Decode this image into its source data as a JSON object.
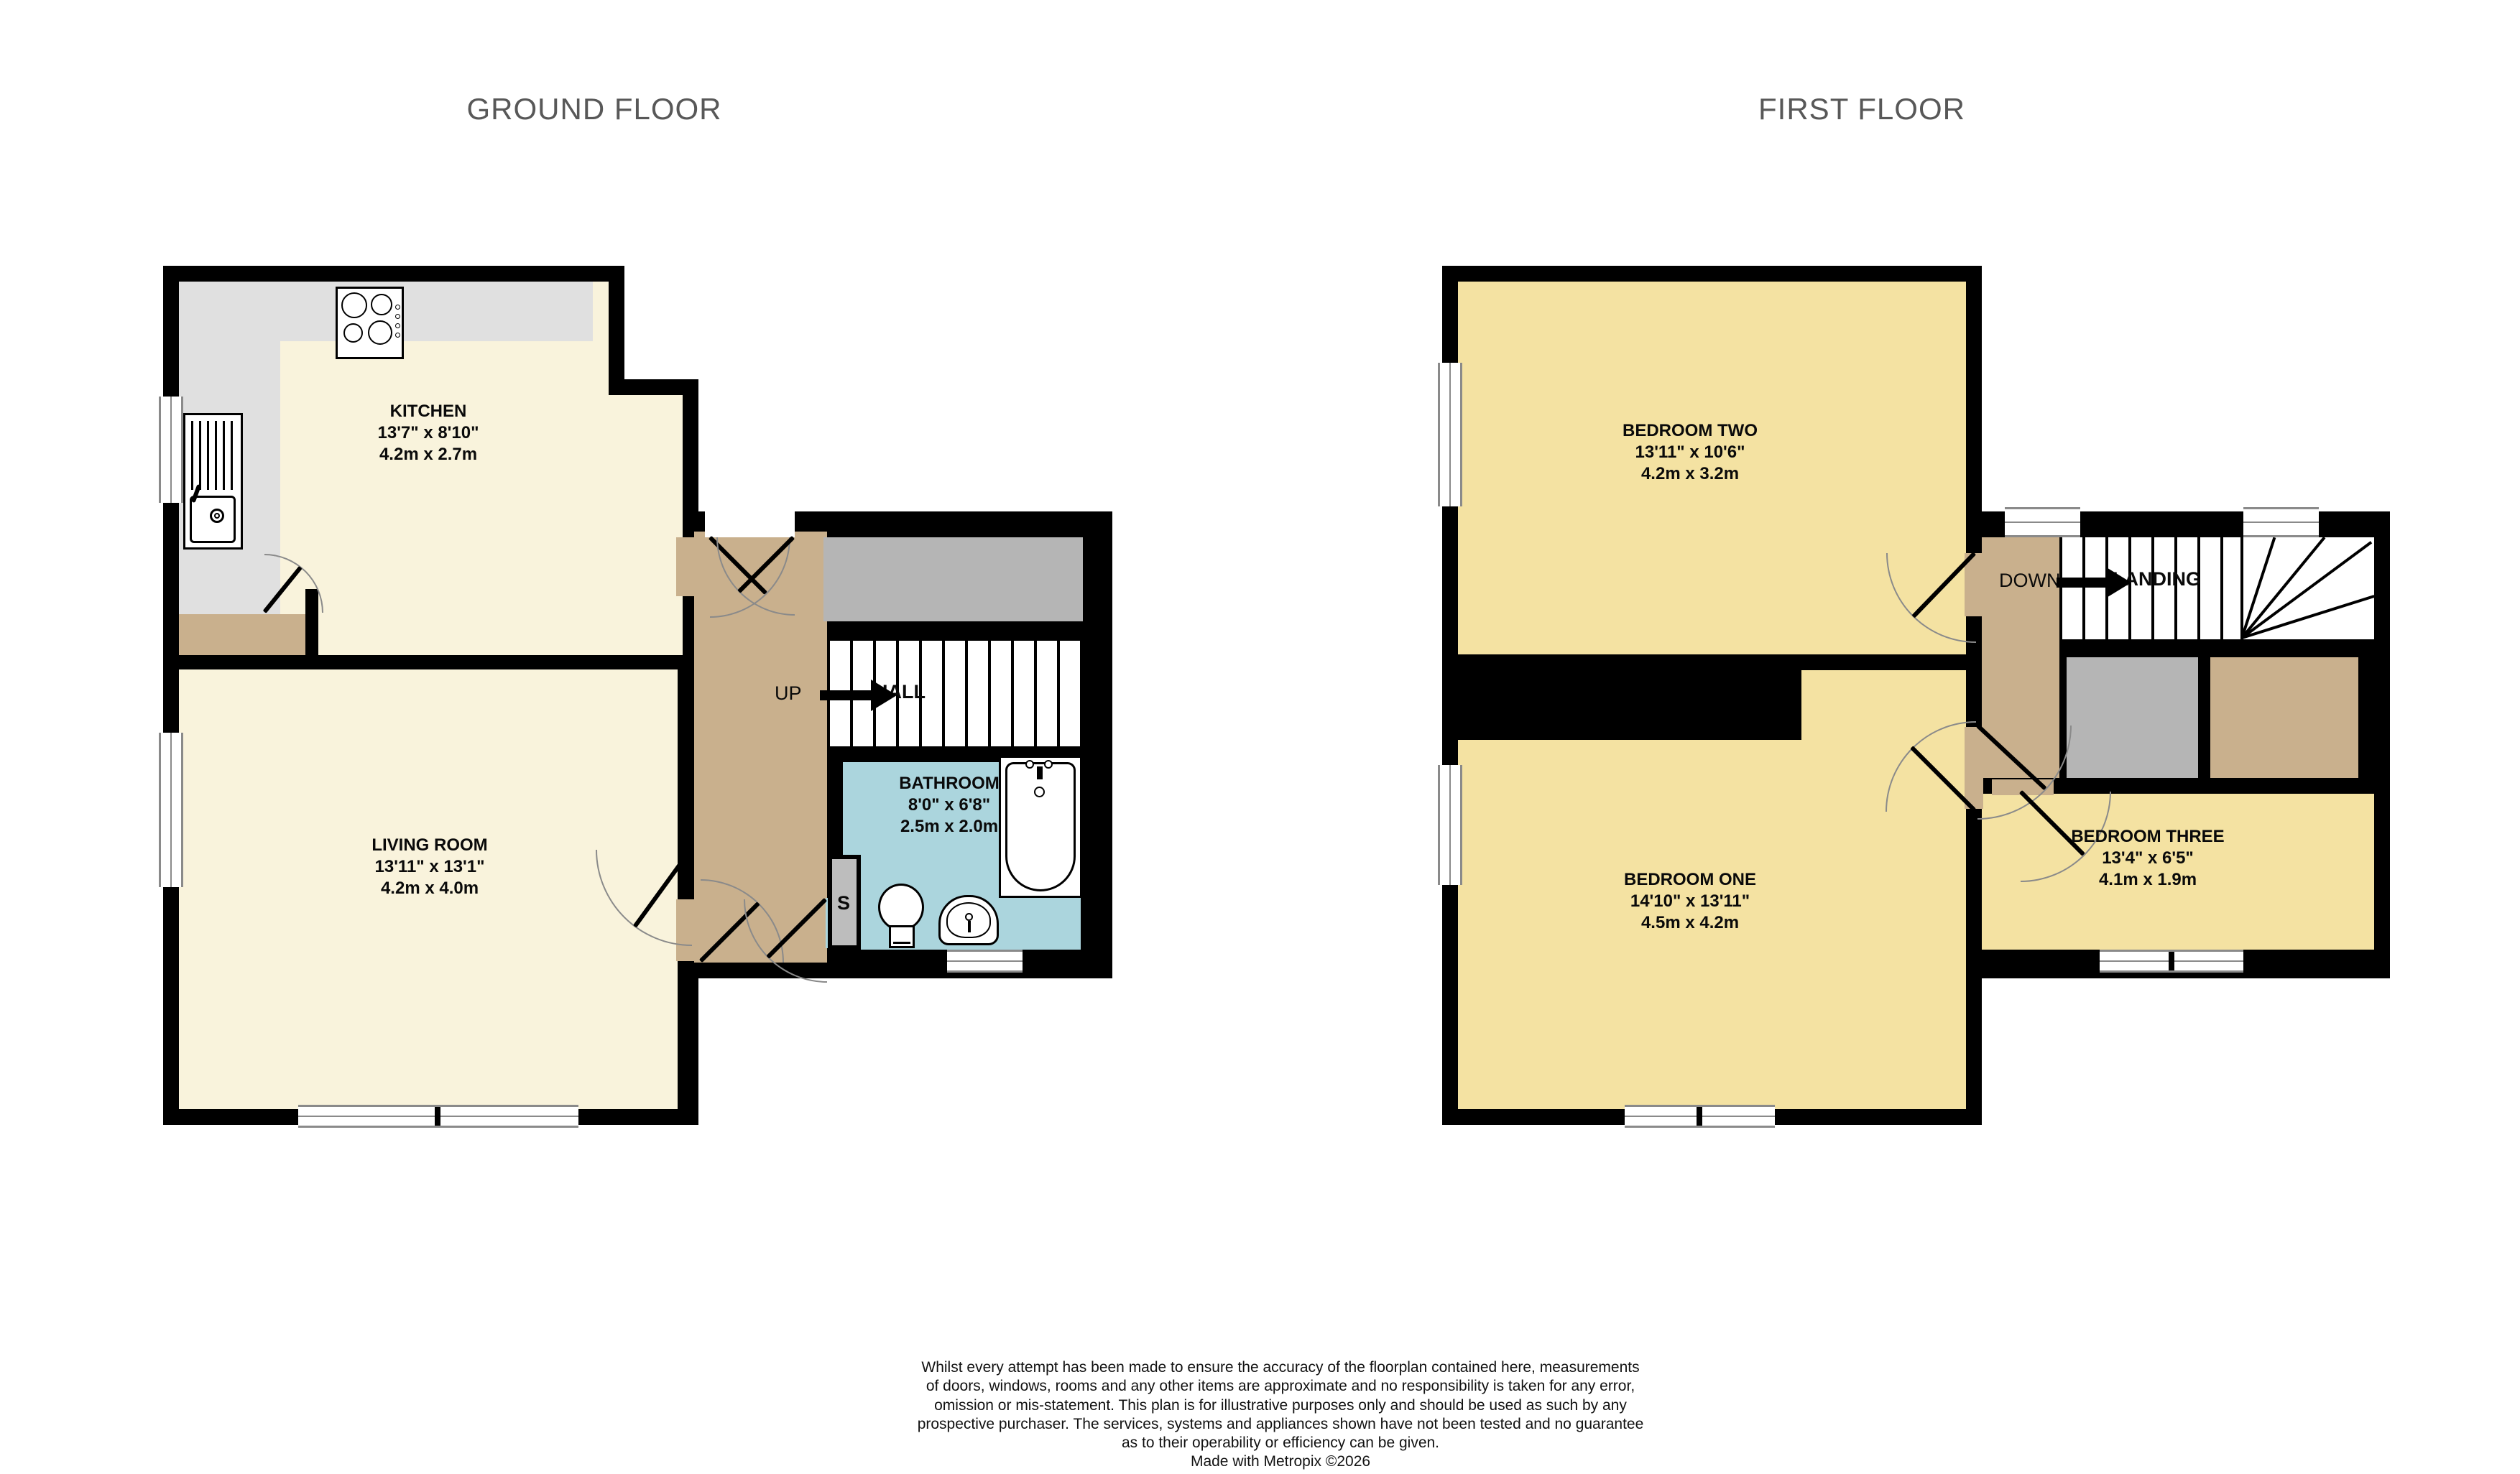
{
  "floors": {
    "ground": {
      "title": "GROUND FLOOR",
      "rooms": {
        "kitchen": {
          "name": "KITCHEN",
          "imperial": "13'7\"  x 8'10\"",
          "metric": "4.2m  x 2.7m"
        },
        "living_room": {
          "name": "LIVING ROOM",
          "imperial": "13'11\"  x 13'1\"",
          "metric": "4.2m  x 4.0m"
        },
        "bathroom": {
          "name": "BATHROOM",
          "imperial": "8'0\"  x 6'8\"",
          "metric": "2.5m  x 2.0m"
        }
      },
      "labels": {
        "up": "UP",
        "hall": "HALL",
        "cupboard": "S"
      }
    },
    "first": {
      "title": "FIRST FLOOR",
      "rooms": {
        "bedroom_one": {
          "name": "BEDROOM ONE",
          "imperial": "14'10\"  x 13'11\"",
          "metric": "4.5m  x 4.2m"
        },
        "bedroom_two": {
          "name": "BEDROOM TWO",
          "imperial": "13'11\"  x 10'6\"",
          "metric": "4.2m  x 3.2m"
        },
        "bedroom_three": {
          "name": "BEDROOM THREE",
          "imperial": "13'4\"  x 6'5\"",
          "metric": "4.1m  x 1.9m"
        }
      },
      "labels": {
        "down": "DOWN",
        "landing": "LANDING"
      }
    }
  },
  "disclaimer": {
    "lines": [
      "Whilst every attempt has been made to ensure the accuracy of the floorplan contained here, measurements",
      "of doors, windows, rooms and any other items are approximate and no responsibility is taken for any error,",
      "omission or mis-statement. This plan is for illustrative purposes only and should be used as such by any",
      "prospective purchaser. The services, systems and appliances shown have not been tested and no guarantee",
      "as to their operability or efficiency can be given.",
      "Made with Metropix ©2026"
    ]
  },
  "icons": {
    "hob_icon": "four-burner-gas-hob (css circles)",
    "sink_icon": "sink-with-drainer (css lines)",
    "bath_icon": "bathtub (rounded rect)",
    "toilet_icon": "toilet (ellipse + cistern)",
    "basin_icon": "wash-basin (round bowl)",
    "up_arrow_icon": "black-right-arrow",
    "down_arrow_icon": "black-right-arrow"
  },
  "colors": {
    "wall": "#000000",
    "ground_room_fill": "#F9F3DC",
    "first_room_fill": "#F4E2A2",
    "hall_landing_fill": "#C9B08D",
    "bathroom_fill": "#ABD5DD",
    "kitchen_counter": "#E0E0E0",
    "stair_head_gray": "#B5B5B5",
    "cupboard_gray": "#BDBDBD",
    "title_text": "#585858"
  }
}
